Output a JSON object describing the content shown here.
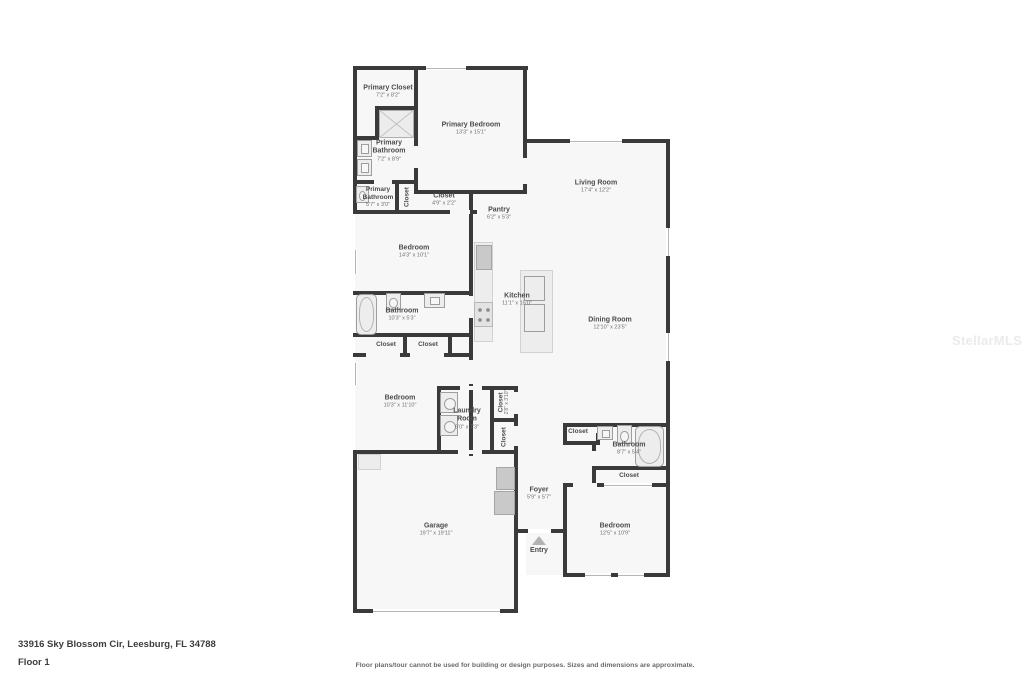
{
  "page": {
    "address": "33916 Sky Blossom Cir, Leesburg, FL 34788",
    "floor_label": "Floor 1",
    "disclaimer": "Floor plans/tour cannot be used for building or design purposes. Sizes and dimensions are approximate.",
    "watermark": "StellarMLS"
  },
  "colors": {
    "wall": "#3a3a3a",
    "floor": "#f7f7f7",
    "label": "#4c4c4c",
    "dims": "#6f6f6f"
  },
  "rooms": {
    "primary_closet": {
      "name": "Primary Closet",
      "dims": "7'2\" x 8'2\""
    },
    "primary_bedroom": {
      "name": "Primary Bedroom",
      "dims": "13'3\" x 15'1\""
    },
    "primary_bathroom": {
      "name": "Primary Bathroom",
      "dims": "7'2\" x 8'9\""
    },
    "primary_bathroom_2": {
      "name": "Primary Bathroom",
      "dims": "5'7\" x 3'0\""
    },
    "closet_primary": {
      "name": "Closet"
    },
    "closet_hall": {
      "name": "Closet",
      "dims": "4'9\" x 2'2\""
    },
    "pantry": {
      "name": "Pantry",
      "dims": "6'2\" x 5'3\""
    },
    "living_room": {
      "name": "Living Room",
      "dims": "17'4\" x 12'2\""
    },
    "bedroom_2": {
      "name": "Bedroom",
      "dims": "14'3\" x 10'1\""
    },
    "kitchen": {
      "name": "Kitchen",
      "dims": "11'1\" x 15'0\""
    },
    "dining_room": {
      "name": "Dining Room",
      "dims": "12'10\" x 23'5\""
    },
    "bathroom_2": {
      "name": "Bathroom",
      "dims": "10'3\" x 5'3\""
    },
    "closet_b_left": {
      "name": "Closet"
    },
    "closet_b_right": {
      "name": "Closet"
    },
    "bedroom_3": {
      "name": "Bedroom",
      "dims": "10'3\" x 11'10\""
    },
    "laundry": {
      "name": "Laundry Room",
      "dims": "6'0\" x 7'3\""
    },
    "closet_laundry": {
      "name": "Closet",
      "dims": "2'8\" x 3'10\""
    },
    "closet_hall_2": {
      "name": "Closet"
    },
    "garage": {
      "name": "Garage",
      "dims": "19'7\" x 19'11\""
    },
    "foyer": {
      "name": "Foyer",
      "dims": "5'9\" x 5'7\""
    },
    "entry": {
      "name": "Entry"
    },
    "closet_bath_3": {
      "name": "Closet"
    },
    "bathroom_3": {
      "name": "Bathroom",
      "dims": "8'7\" x 5'4\""
    },
    "closet_bed_4": {
      "name": "Closet"
    },
    "bedroom_4": {
      "name": "Bedroom",
      "dims": "12'5\" x 10'9\""
    }
  }
}
